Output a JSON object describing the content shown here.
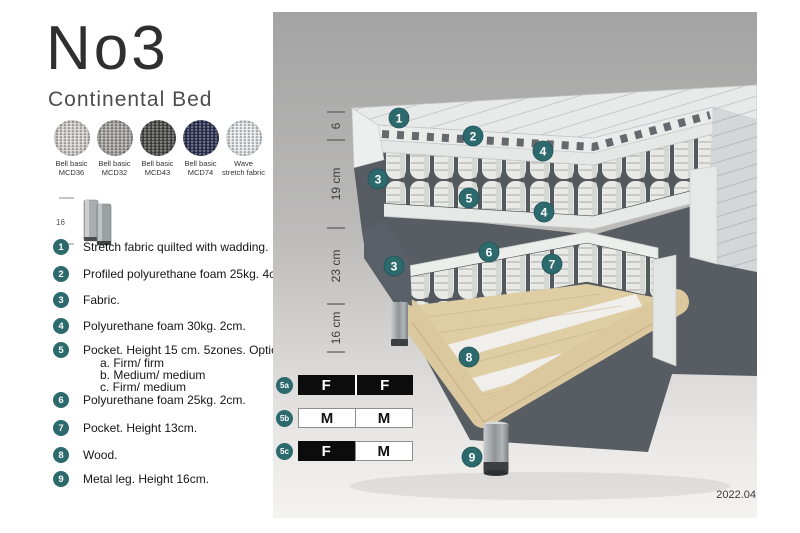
{
  "header": {
    "title": "No3",
    "subtitle": "Continental Bed"
  },
  "swatches": [
    {
      "line1": "Bell basic",
      "line2": "MCD36",
      "color": "#d7d4cf"
    },
    {
      "line1": "Bell basic",
      "line2": "MCD32",
      "color": "#a7a6a2"
    },
    {
      "line1": "Bell basic",
      "line2": "MCD43",
      "color": "#4d4d4a"
    },
    {
      "line1": "Bell basic",
      "line2": "MCD74",
      "color": "#2f3354"
    },
    {
      "line1": "Wave",
      "line2": "stretch fabric",
      "color": "#e9ebee"
    }
  ],
  "leg_thumbnail": {
    "height_label": "16"
  },
  "legend": [
    {
      "num": "1",
      "text": "Stretch fabric quilted with wadding."
    },
    {
      "num": "2",
      "text": "Profiled polyurethane foam 25kg. 4cm."
    },
    {
      "num": "3",
      "text": "Fabric."
    },
    {
      "num": "4",
      "text": "Polyurethane foam 30kg. 2cm."
    },
    {
      "num": "5",
      "text": "Pocket. Height 15 cm. 5zones. Option:",
      "options": [
        "a. Firm/ firm",
        "b. Medium/ medium",
        "c. Firm/ medium"
      ]
    },
    {
      "num": "6",
      "text": "Polyurethane foam 25kg. 2cm."
    },
    {
      "num": "7",
      "text": "Pocket. Height 13cm."
    },
    {
      "num": "8",
      "text": "Wood."
    },
    {
      "num": "9",
      "text": "Metal leg. Height 16cm."
    }
  ],
  "diagram": {
    "dimensions": [
      "6",
      "19 cm",
      "23 cm",
      "16 cm"
    ],
    "callouts": {
      "c1": "1",
      "c2": "2",
      "c3": "3",
      "c4": "4",
      "c5": "5",
      "c6": "6",
      "c7": "7",
      "c8": "8",
      "c9": "9"
    },
    "firmness_rows": [
      {
        "id": "5a",
        "cells": [
          {
            "letter": "F",
            "dark": true
          },
          {
            "letter": "F",
            "dark": true
          }
        ]
      },
      {
        "id": "5b",
        "cells": [
          {
            "letter": "M",
            "dark": false
          },
          {
            "letter": "M",
            "dark": false
          }
        ]
      },
      {
        "id": "5c",
        "cells": [
          {
            "letter": "F",
            "dark": true
          },
          {
            "letter": "M",
            "dark": false
          }
        ]
      }
    ],
    "version": "2022.04"
  },
  "colors": {
    "accent_teal": "#2d6a6e",
    "fabric_gray": "#585e64",
    "wood": "#dcc89e"
  }
}
